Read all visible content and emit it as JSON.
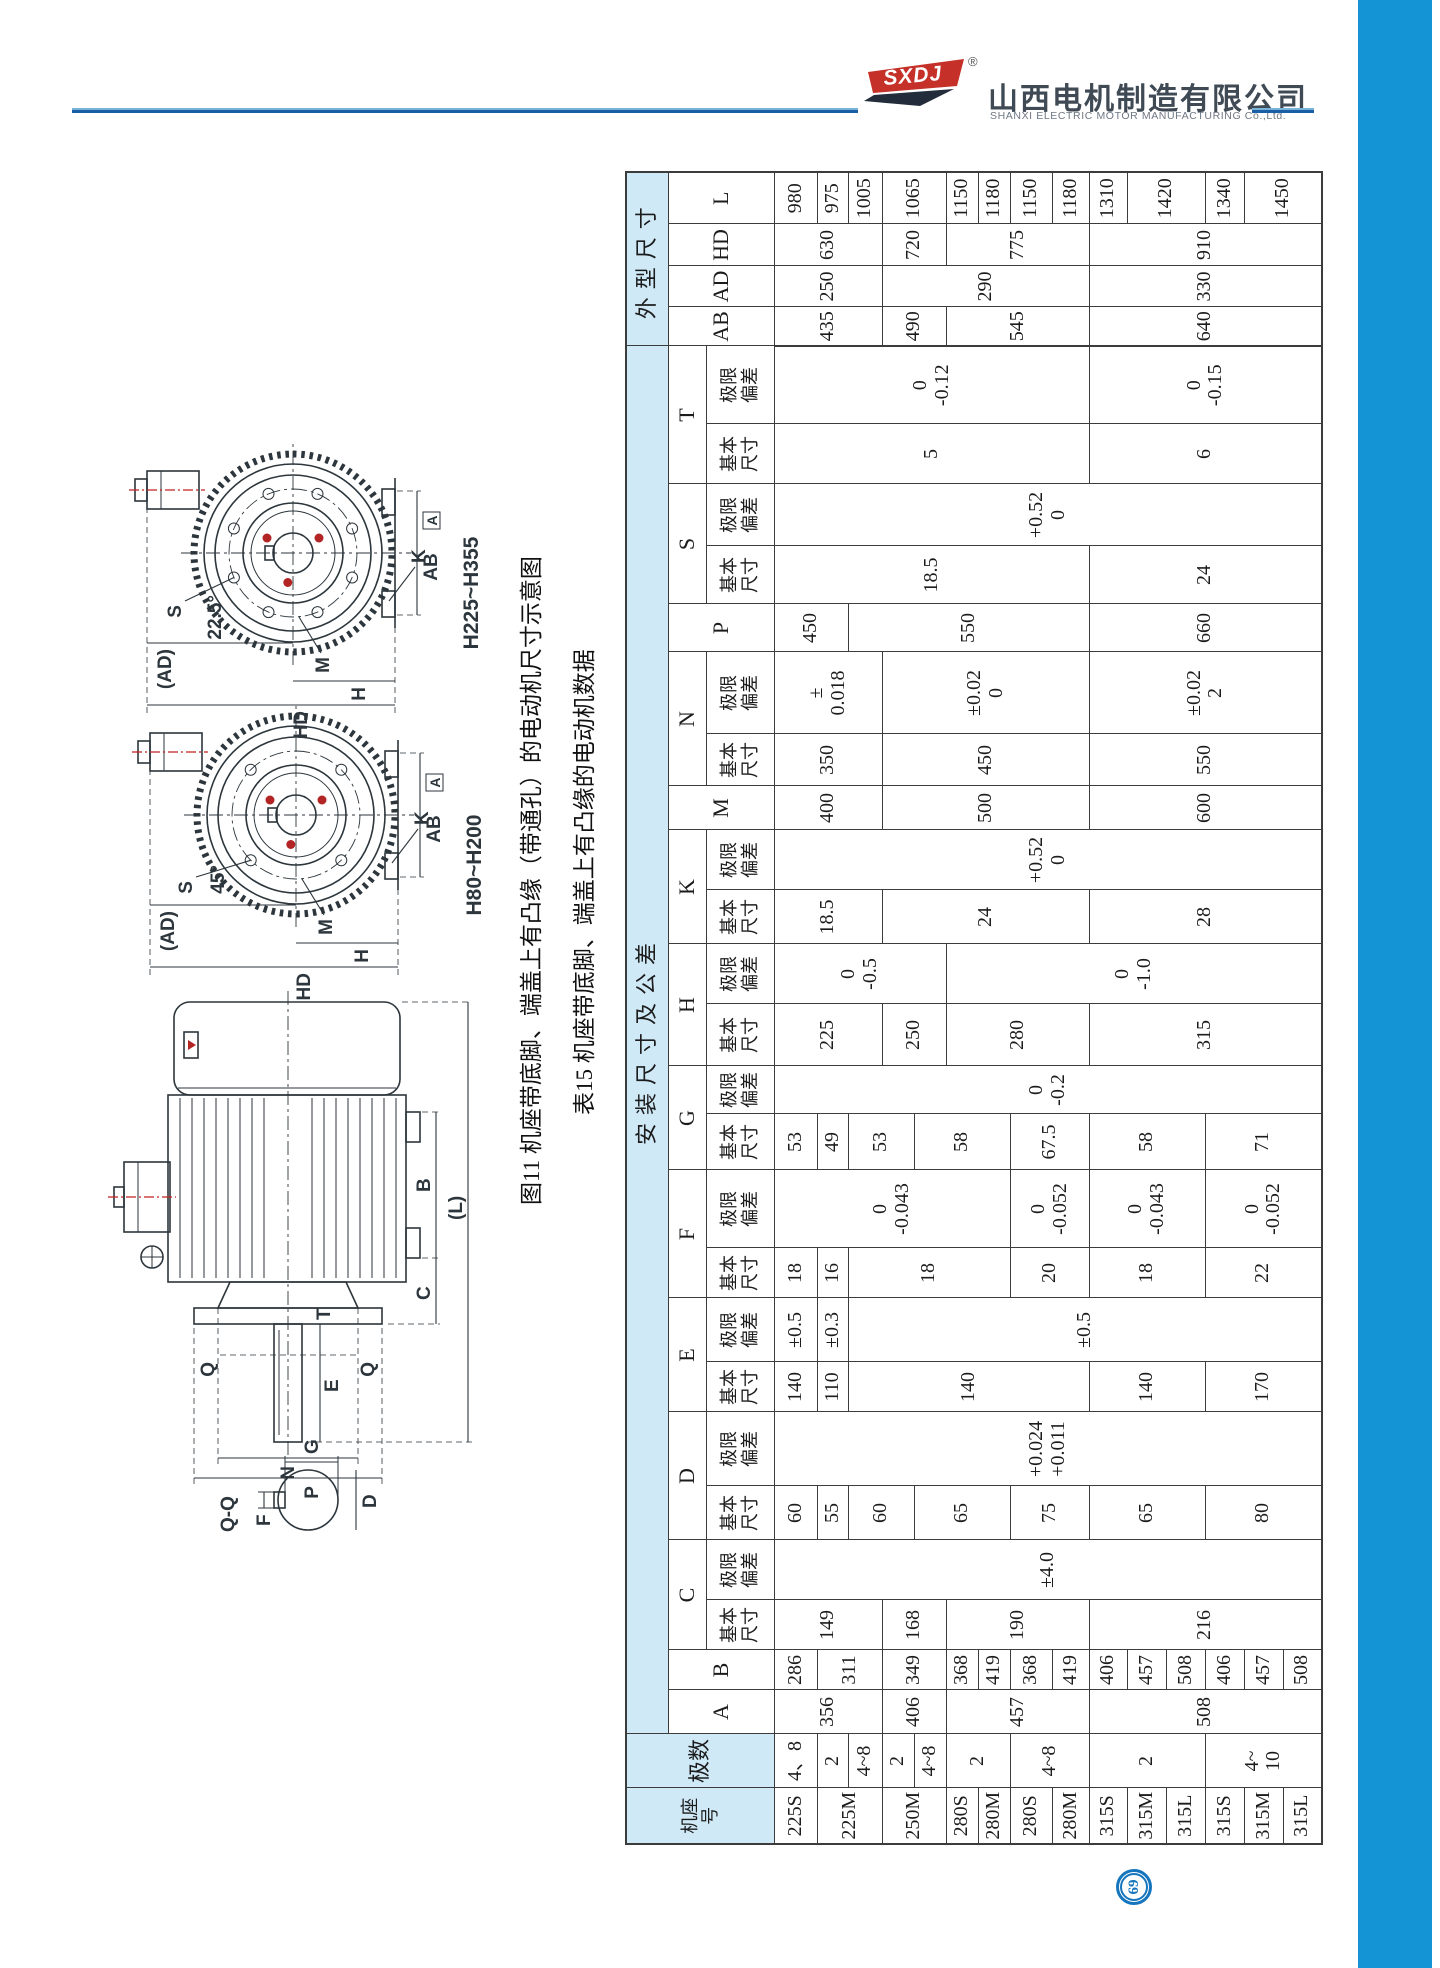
{
  "header": {
    "logo_text": "SXDJ",
    "reg": "®",
    "company_cn": "山西电机制造有限公司",
    "company_en": "SHANXI  ELECTRIC  MOTOR  MANUFACTURING  Co.,Ltd."
  },
  "figure": {
    "caption": "图11 机座带底脚、端盖上有凸缘（带通孔）的电动机尺寸示意图",
    "labels": {
      "ad": "(AD)",
      "s": "S",
      "angle_large": "22.5°",
      "angle_small": "45°",
      "m": "M",
      "h": "H",
      "hd": "HD",
      "k": "K",
      "ab": "AB",
      "datum": "A",
      "range_large": "H225~H355",
      "range_small": "H80~H200",
      "len": "(L)",
      "b": "B",
      "c": "C",
      "e": "E",
      "f": "F",
      "d": "D",
      "g": "G",
      "n": "N",
      "p": "P",
      "t": "T",
      "q": "Q",
      "qq": "Q-Q"
    }
  },
  "table": {
    "title": "表15 机座带底脚、端盖上有凸缘的电动机数据",
    "header": {
      "frame": "机座\n号",
      "poles": "极数",
      "mount_group": "安装尺寸及公差",
      "outline_group": "外型尺寸",
      "basic": "基本\n尺寸",
      "limit": "极限\n偏差"
    },
    "columns": [
      {
        "k": "frame",
        "letter": "机座\n号",
        "sub": null,
        "group": "head"
      },
      {
        "k": "poles",
        "letter": "极数",
        "sub": null,
        "group": "head"
      },
      {
        "k": "A",
        "letter": "A",
        "sub": null,
        "group": "mount"
      },
      {
        "k": "B",
        "letter": "B",
        "sub": null,
        "group": "mount"
      },
      {
        "k": "Cb",
        "letter": "C",
        "sub": "basic",
        "group": "mount"
      },
      {
        "k": "Ct",
        "letter": "C",
        "sub": "limit",
        "group": "mount"
      },
      {
        "k": "Db",
        "letter": "D",
        "sub": "basic",
        "group": "mount"
      },
      {
        "k": "Dt",
        "letter": "D",
        "sub": "limit",
        "group": "mount"
      },
      {
        "k": "Eb",
        "letter": "E",
        "sub": "basic",
        "group": "mount"
      },
      {
        "k": "Et",
        "letter": "E",
        "sub": "limit",
        "group": "mount"
      },
      {
        "k": "Fb",
        "letter": "F",
        "sub": "basic",
        "group": "mount"
      },
      {
        "k": "Ft",
        "letter": "F",
        "sub": "limit",
        "group": "mount"
      },
      {
        "k": "Gb",
        "letter": "G",
        "sub": "basic",
        "group": "mount"
      },
      {
        "k": "Gt",
        "letter": "G",
        "sub": "limit",
        "group": "mount"
      },
      {
        "k": "Hb",
        "letter": "H",
        "sub": "basic",
        "group": "mount"
      },
      {
        "k": "Ht",
        "letter": "H",
        "sub": "limit",
        "group": "mount"
      },
      {
        "k": "Kb",
        "letter": "K",
        "sub": "basic",
        "group": "mount"
      },
      {
        "k": "Kt",
        "letter": "K",
        "sub": "limit",
        "group": "mount"
      },
      {
        "k": "M",
        "letter": "M",
        "sub": null,
        "group": "mount"
      },
      {
        "k": "Nb",
        "letter": "N",
        "sub": "basic",
        "group": "mount"
      },
      {
        "k": "Nt",
        "letter": "N",
        "sub": "limit",
        "group": "mount"
      },
      {
        "k": "P",
        "letter": "P",
        "sub": null,
        "group": "mount"
      },
      {
        "k": "Sb",
        "letter": "S",
        "sub": "basic",
        "group": "mount"
      },
      {
        "k": "St",
        "letter": "S",
        "sub": "limit",
        "group": "mount"
      },
      {
        "k": "Tb",
        "letter": "T",
        "sub": "basic",
        "group": "mount"
      },
      {
        "k": "Tt",
        "letter": "T",
        "sub": "limit",
        "group": "mount"
      },
      {
        "k": "AB",
        "letter": "AB",
        "sub": null,
        "group": "outline"
      },
      {
        "k": "AD",
        "letter": "AD",
        "sub": null,
        "group": "outline"
      },
      {
        "k": "HD",
        "letter": "HD",
        "sub": null,
        "group": "outline"
      },
      {
        "k": "L",
        "letter": "L",
        "sub": null,
        "group": "outline"
      }
    ],
    "rows": [
      [
        [
          "frame",
          "225S"
        ],
        [
          "poles",
          "4、8"
        ],
        [
          "A",
          "356",
          3
        ],
        [
          "B",
          "286"
        ],
        [
          "Cb",
          "149",
          3
        ],
        [
          "Ct",
          "±4.0",
          15
        ],
        [
          "Db",
          "60"
        ],
        [
          "Dt",
          "+0.024\n+0.011",
          15
        ],
        [
          "Eb",
          "140"
        ],
        [
          "Et",
          "±0.5"
        ],
        [
          "Fb",
          "18"
        ],
        [
          "Ft",
          "0\n-0.043",
          7
        ],
        [
          "Gb",
          "53"
        ],
        [
          "Gt",
          "0\n-0.2",
          15
        ],
        [
          "Hb",
          "225",
          3
        ],
        [
          "Ht",
          "0\n-0.5",
          5
        ],
        [
          "Kb",
          "18.5",
          3
        ],
        [
          "Kt",
          "+0.52\n0",
          15
        ],
        [
          "M",
          "400",
          3
        ],
        [
          "Nb",
          "350",
          3
        ],
        [
          "Nt",
          "±\n0.018",
          3
        ],
        [
          "P",
          "450",
          2
        ],
        [
          "Sb",
          "18.5",
          9
        ],
        [
          "St",
          "+0.52\n0",
          15
        ],
        [
          "Tb",
          "5",
          9
        ],
        [
          "Tt",
          "0\n-0.12",
          9
        ],
        [
          "AB",
          "435",
          3
        ],
        [
          "AD",
          "250",
          3
        ],
        [
          "HD",
          "630",
          3
        ],
        [
          "L",
          "980"
        ]
      ],
      [
        [
          "frame",
          "225M",
          2
        ],
        [
          "poles",
          "2"
        ],
        [
          "B",
          "311",
          2
        ],
        [
          "Db",
          "55"
        ],
        [
          "Eb",
          "110"
        ],
        [
          "Et",
          "±0.3"
        ],
        [
          "Fb",
          "16"
        ],
        [
          "Gb",
          "49"
        ],
        [
          "L",
          "975"
        ]
      ],
      [
        [
          "poles",
          "4~8"
        ],
        [
          "Db",
          "60",
          2
        ],
        [
          "Eb",
          "140",
          7
        ],
        [
          "Et",
          "±0.5",
          13
        ],
        [
          "Fb",
          "18",
          5
        ],
        [
          "Gb",
          "53",
          2
        ],
        [
          "P",
          "550",
          7
        ],
        [
          "L",
          "1005"
        ]
      ],
      [
        [
          "frame",
          "250M",
          2
        ],
        [
          "poles",
          "2"
        ],
        [
          "A",
          "406",
          2
        ],
        [
          "B",
          "349",
          2
        ],
        [
          "Cb",
          "168",
          2
        ],
        [
          "Hb",
          "250",
          2
        ],
        [
          "Kb",
          "24",
          6
        ],
        [
          "M",
          "500",
          6
        ],
        [
          "Nb",
          "450",
          6
        ],
        [
          "Nt",
          "±0.02\n0",
          6
        ],
        [
          "AB",
          "490",
          2
        ],
        [
          "AD",
          "290",
          6
        ],
        [
          "HD",
          "720",
          2
        ],
        [
          "L",
          "1065",
          2
        ]
      ],
      [
        [
          "poles",
          "4~8"
        ],
        [
          "Db",
          "65",
          3
        ],
        [
          "Gb",
          "58",
          3
        ]
      ],
      [
        [
          "frame",
          "280S"
        ],
        [
          "poles",
          "2",
          2
        ],
        [
          "A",
          "457",
          4
        ],
        [
          "B",
          "368"
        ],
        [
          "Cb",
          "190",
          4
        ],
        [
          "Hb",
          "280",
          4
        ],
        [
          "Ht",
          "0\n-1.0",
          10
        ],
        [
          "AB",
          "545",
          4
        ],
        [
          "HD",
          "775",
          4
        ],
        [
          "L",
          "1150"
        ]
      ],
      [
        [
          "frame",
          "280M"
        ],
        [
          "B",
          "419"
        ],
        [
          "L",
          "1180"
        ]
      ],
      [
        [
          "frame",
          "280S"
        ],
        [
          "poles",
          "4~8",
          2
        ],
        [
          "B",
          "368"
        ],
        [
          "Db",
          "75",
          2
        ],
        [
          "Fb",
          "20",
          2
        ],
        [
          "Ft",
          "0\n-0.052",
          2
        ],
        [
          "Gb",
          "67.5",
          2
        ],
        [
          "L",
          "1150"
        ]
      ],
      [
        [
          "frame",
          "280M"
        ],
        [
          "B",
          "419"
        ],
        [
          "L",
          "1180"
        ]
      ],
      [
        [
          "frame",
          "315S"
        ],
        [
          "poles",
          "2",
          3
        ],
        [
          "A",
          "508",
          6
        ],
        [
          "B",
          "406"
        ],
        [
          "Cb",
          "216",
          6
        ],
        [
          "Db",
          "65",
          3
        ],
        [
          "Eb",
          "140",
          3
        ],
        [
          "Fb",
          "18",
          3
        ],
        [
          "Ft",
          "0\n-0.043",
          3
        ],
        [
          "Gb",
          "58",
          3
        ],
        [
          "Hb",
          "315",
          6
        ],
        [
          "Kb",
          "28",
          6
        ],
        [
          "M",
          "600",
          6
        ],
        [
          "Nb",
          "550",
          6
        ],
        [
          "Nt",
          "±0.02\n2",
          6
        ],
        [
          "P",
          "660",
          6
        ],
        [
          "Sb",
          "24",
          6
        ],
        [
          "Tb",
          "6",
          6
        ],
        [
          "Tt",
          "0\n-0.15",
          6
        ],
        [
          "AB",
          "640",
          6
        ],
        [
          "AD",
          "330",
          6
        ],
        [
          "HD",
          "910",
          6
        ],
        [
          "L",
          "1310"
        ]
      ],
      [
        [
          "frame",
          "315M"
        ],
        [
          "B",
          "457"
        ],
        [
          "L",
          "1420",
          2
        ]
      ],
      [
        [
          "frame",
          "315L"
        ],
        [
          "B",
          "508"
        ]
      ],
      [
        [
          "frame",
          "315S"
        ],
        [
          "poles",
          "4~\n10",
          3
        ],
        [
          "B",
          "406"
        ],
        [
          "Db",
          "80",
          3
        ],
        [
          "Eb",
          "170",
          3
        ],
        [
          "Fb",
          "22",
          3
        ],
        [
          "Ft",
          "0\n-0.052",
          3
        ],
        [
          "Gb",
          "71",
          3
        ],
        [
          "L",
          "1340"
        ]
      ],
      [
        [
          "frame",
          "315M"
        ],
        [
          "B",
          "457"
        ],
        [
          "L",
          "1450",
          2
        ]
      ],
      [
        [
          "frame",
          "315L"
        ],
        [
          "B",
          "508"
        ]
      ]
    ]
  },
  "page": {
    "number": "69"
  },
  "colors": {
    "band_blue": "#cfe9f7",
    "sidebar_blue": "#1494d4",
    "rule_blue": "#1a5fa6",
    "logo_red": "#c53028",
    "badge_blue": "#1576be",
    "drawing_red": "#b32424"
  }
}
